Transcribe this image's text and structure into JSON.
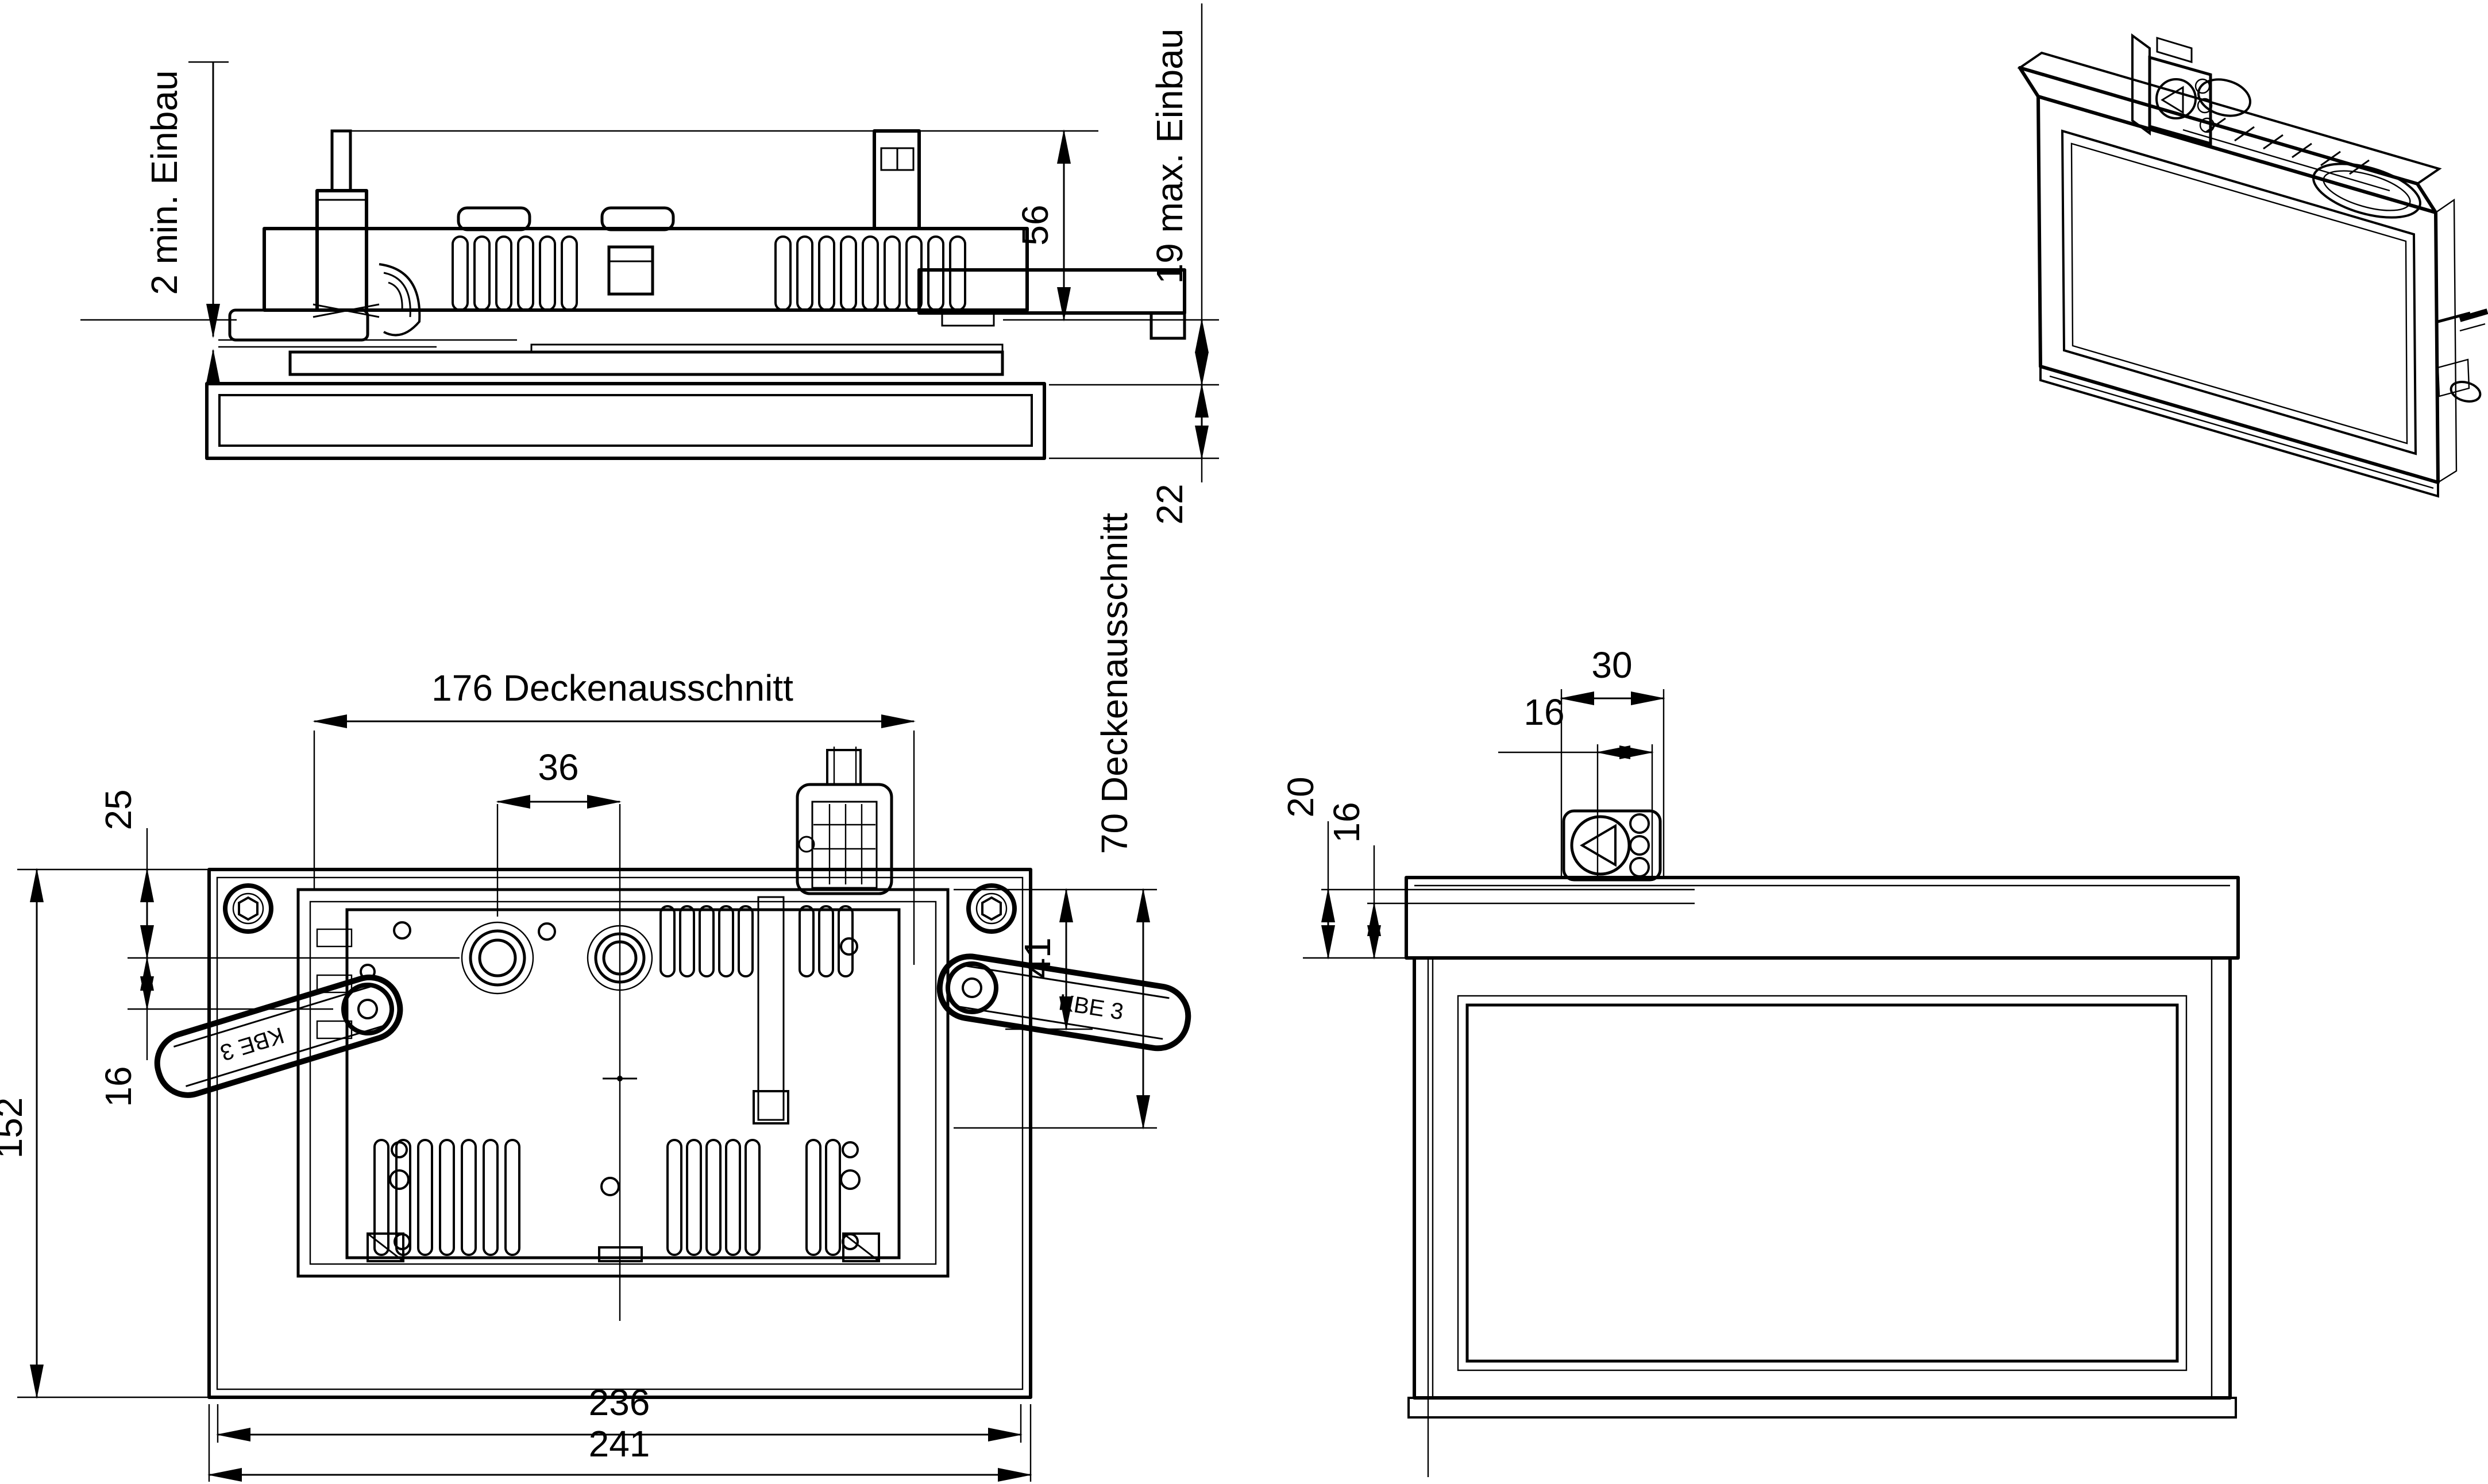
{
  "colors": {
    "ink": "#000000",
    "paper": "#ffffff"
  },
  "dims": {
    "side": {
      "min_recess": "2 min. Einbau",
      "recess_height": "56",
      "max_ceiling": "19 max. Einbau",
      "frame_height": "22"
    },
    "top": {
      "cutout_width": "176 Deckenausschnitt",
      "gland_spacing": "36",
      "top_to_gland": "25",
      "gland_to_pivot": "16",
      "housing_depth": "152",
      "tray_depth": "41",
      "cutout_depth": "70 Deckenausschnitt",
      "inner_width": "236",
      "overall_width": "241"
    },
    "front": {
      "terminal_width": "30",
      "terminal_inner": "16",
      "recess_left": "20",
      "recess_inner": "16"
    }
  },
  "labels": {
    "clamp_left": "KBE 3",
    "clamp_right": "KBE 3"
  }
}
